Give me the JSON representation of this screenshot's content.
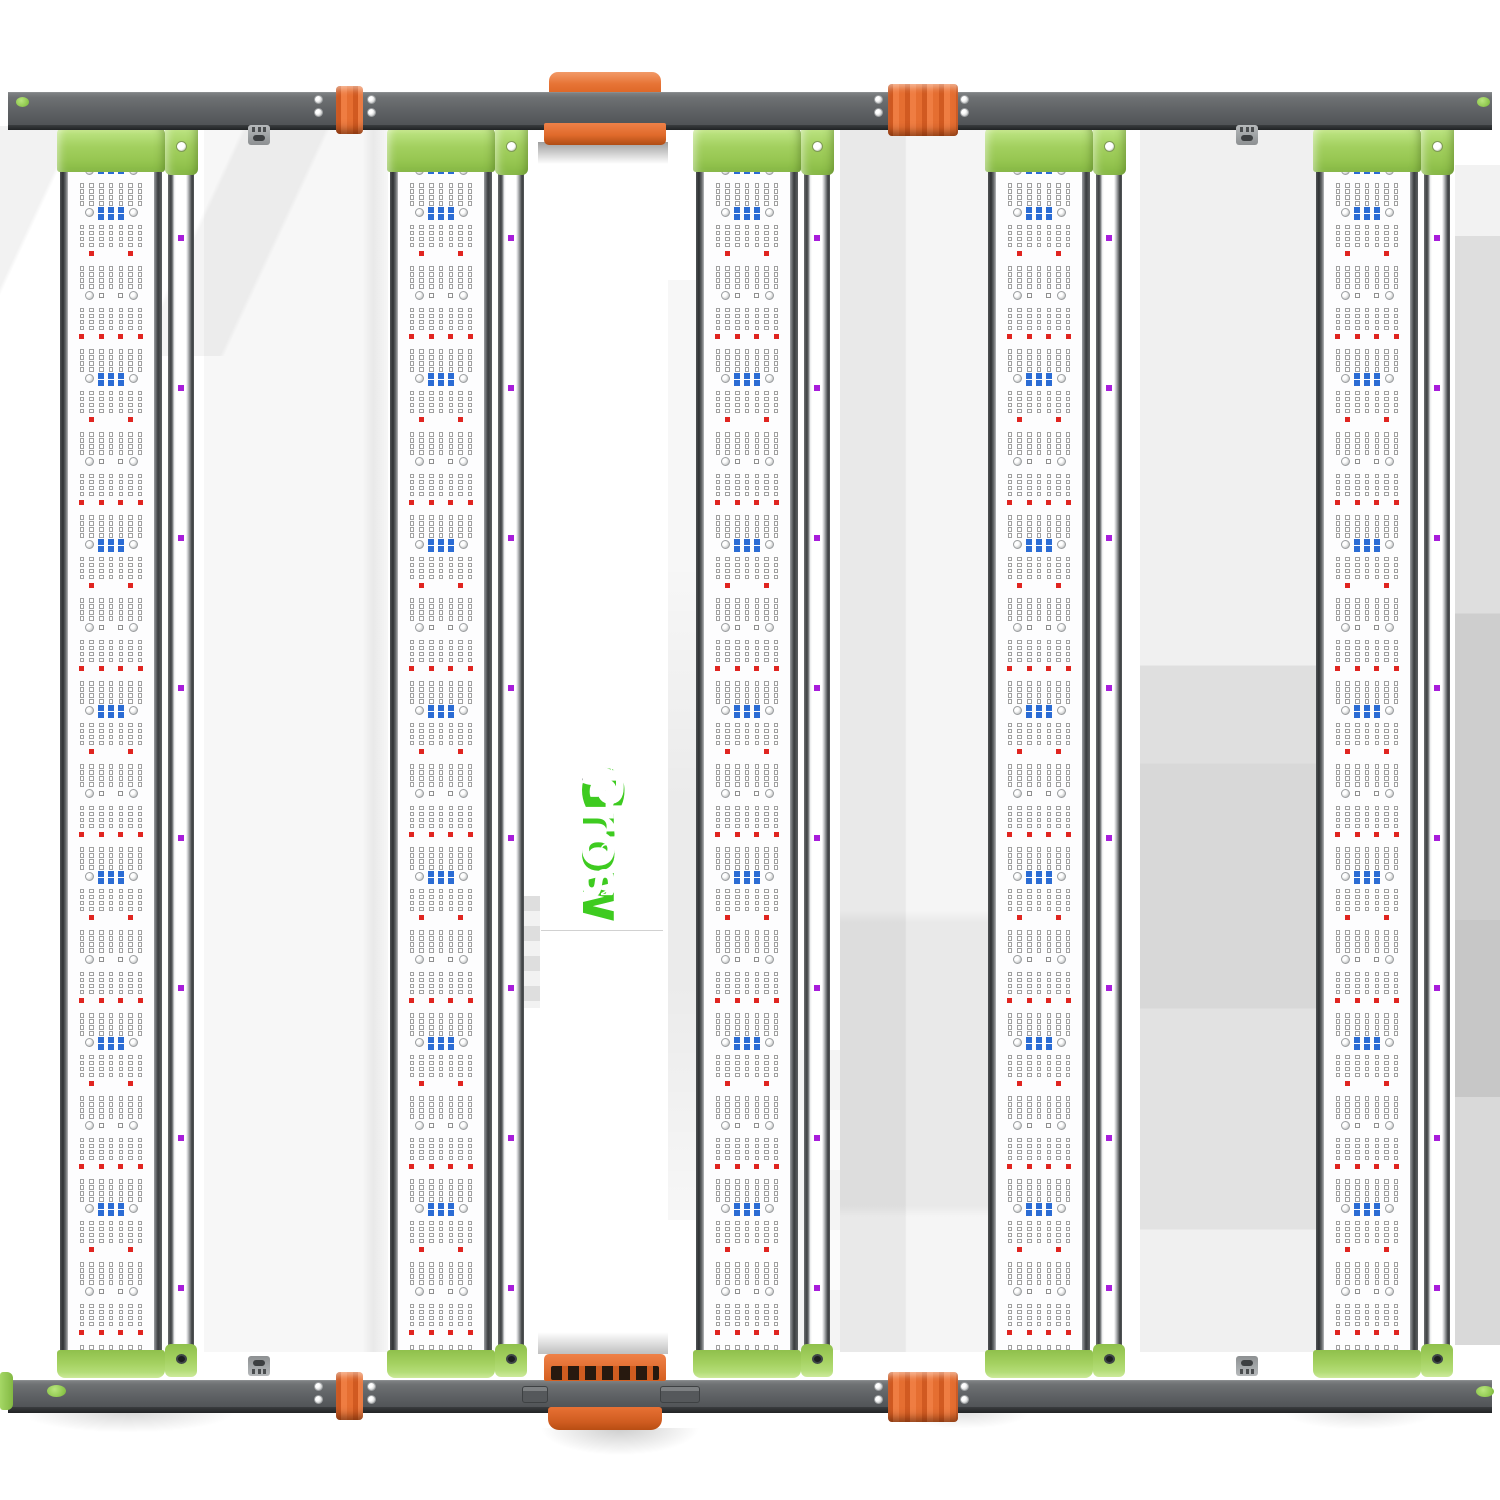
{
  "logo": {
    "grow": "Grow",
    "pros": "Pros",
    "solutions": "S O L U T I O N S"
  },
  "colors": {
    "logo_green": "#3ecb20",
    "cap_green": "#a3d05f",
    "orange": "#e7743 6",
    "orange_fix": "#e77436",
    "rail_gray": "#5f6265",
    "spine_gray": "#717476",
    "pcb_white": "#fdfdfe",
    "led_red": "#e02520",
    "led_blue": "#2b6cd4",
    "led_purple": "#a81ddb"
  },
  "fixture": {
    "bar_count": 5,
    "bars_x": [
      60,
      390,
      696,
      988,
      1316
    ],
    "bar": {
      "outer_w": 102,
      "pcb_dx": 8,
      "pcb_w": 86,
      "top": 152,
      "height": 1200,
      "strip_dx": 108,
      "strip_w": 26
    },
    "pattern": {
      "first_y": 18,
      "step": 41.5,
      "cols": 7,
      "col0": 13.9,
      "col_pitch": 9.7,
      "grid_row_off": 13,
      "grid_row_pitch": 6,
      "screw_x": [
        21,
        65
      ],
      "blue_cols": [
        2,
        3,
        4
      ],
      "marker_cols": [
        2,
        4
      ],
      "red2_cols": [
        1,
        5
      ],
      "red4_cols": [
        0,
        2,
        4,
        6
      ],
      "purple_first_y": 83,
      "purple_step": 150
    },
    "rails": {
      "top_y": 92,
      "top_h": 33,
      "bottom_y": 1380,
      "bottom_h": 27
    },
    "screw_pairs_x": [
      318,
      371,
      878,
      964
    ],
    "hanger_brackets_x": [
      248,
      1236
    ],
    "clips": [
      {
        "x": 336,
        "y": 86,
        "w": 27,
        "h": 48
      },
      {
        "x": 888,
        "y": 84,
        "w": 70,
        "h": 52
      },
      {
        "x": 336,
        "y": 1372,
        "w": 27,
        "h": 48
      },
      {
        "x": 888,
        "y": 1372,
        "w": 70,
        "h": 50
      }
    ],
    "rail_dots": [
      {
        "x": 16,
        "y": 97,
        "w": 13,
        "h": 10
      },
      {
        "x": 1477,
        "y": 97,
        "w": 13,
        "h": 10
      },
      {
        "x": 47,
        "y": 1385,
        "w": 19,
        "h": 12
      },
      {
        "x": 1476,
        "y": 1386,
        "w": 18,
        "h": 11
      }
    ],
    "rail_tabs": [
      {
        "x": 522,
        "y": 1386,
        "w": 26,
        "h": 17
      },
      {
        "x": 660,
        "y": 1386,
        "w": 40,
        "h": 17
      }
    ]
  }
}
